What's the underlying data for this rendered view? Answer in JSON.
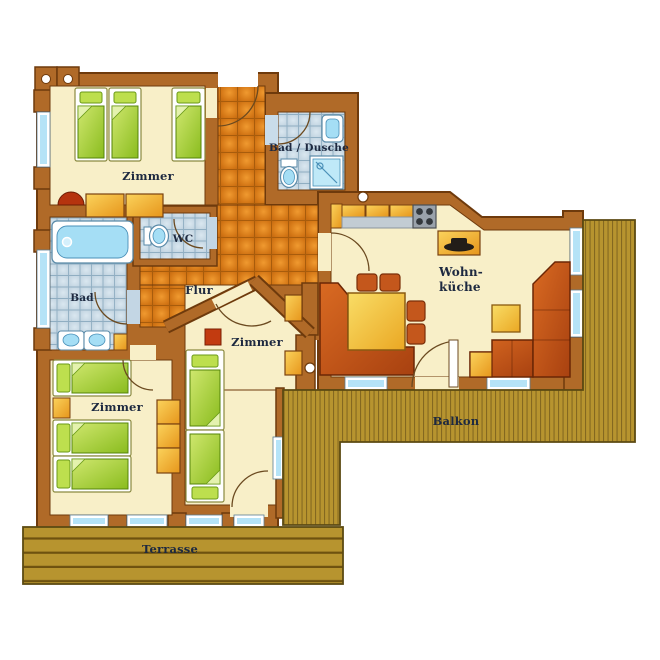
{
  "title": "Apartment floor plan",
  "rooms": [
    {
      "id": "bedroom-top-left",
      "label": "Zimmer"
    },
    {
      "id": "shower-bath",
      "label": "Bad / Dusche"
    },
    {
      "id": "wc",
      "label": "WC"
    },
    {
      "id": "hallway",
      "label": "Flur"
    },
    {
      "id": "bathroom",
      "label": "Bad"
    },
    {
      "id": "bedroom-middle",
      "label": "Zimmer"
    },
    {
      "id": "bedroom-bottom-left",
      "label": "Zimmer"
    },
    {
      "id": "living-kitchen",
      "label_line1": "Wohn-",
      "label_line2": "küche"
    },
    {
      "id": "balcony",
      "label": "Balkon"
    },
    {
      "id": "terrace",
      "label": "Terrasse"
    }
  ],
  "fixtures": [
    "bed",
    "pillow",
    "wardrobe",
    "dresser",
    "bathtub",
    "double-sink",
    "toilet",
    "shower",
    "washbasin",
    "kitchen-counter",
    "stove",
    "tv-sideboard",
    "dining-table",
    "chair",
    "corner-bench",
    "sofa",
    "coffee-table",
    "stool",
    "door",
    "window",
    "deck-planks"
  ],
  "colors": {
    "wall": "#b06a28",
    "wall_outline": "#6e3a0c",
    "floor_cream": "#f8efc8",
    "tile_orange": "#d4791b",
    "tile_blue": "#c3d6e4",
    "deck_wood": "#b7942f",
    "bed_green": "#9cc832",
    "furniture_orange": "#eda42c",
    "seating_red": "#c4571c",
    "water_blue": "#a5def5",
    "label_text": "#1d2940"
  }
}
